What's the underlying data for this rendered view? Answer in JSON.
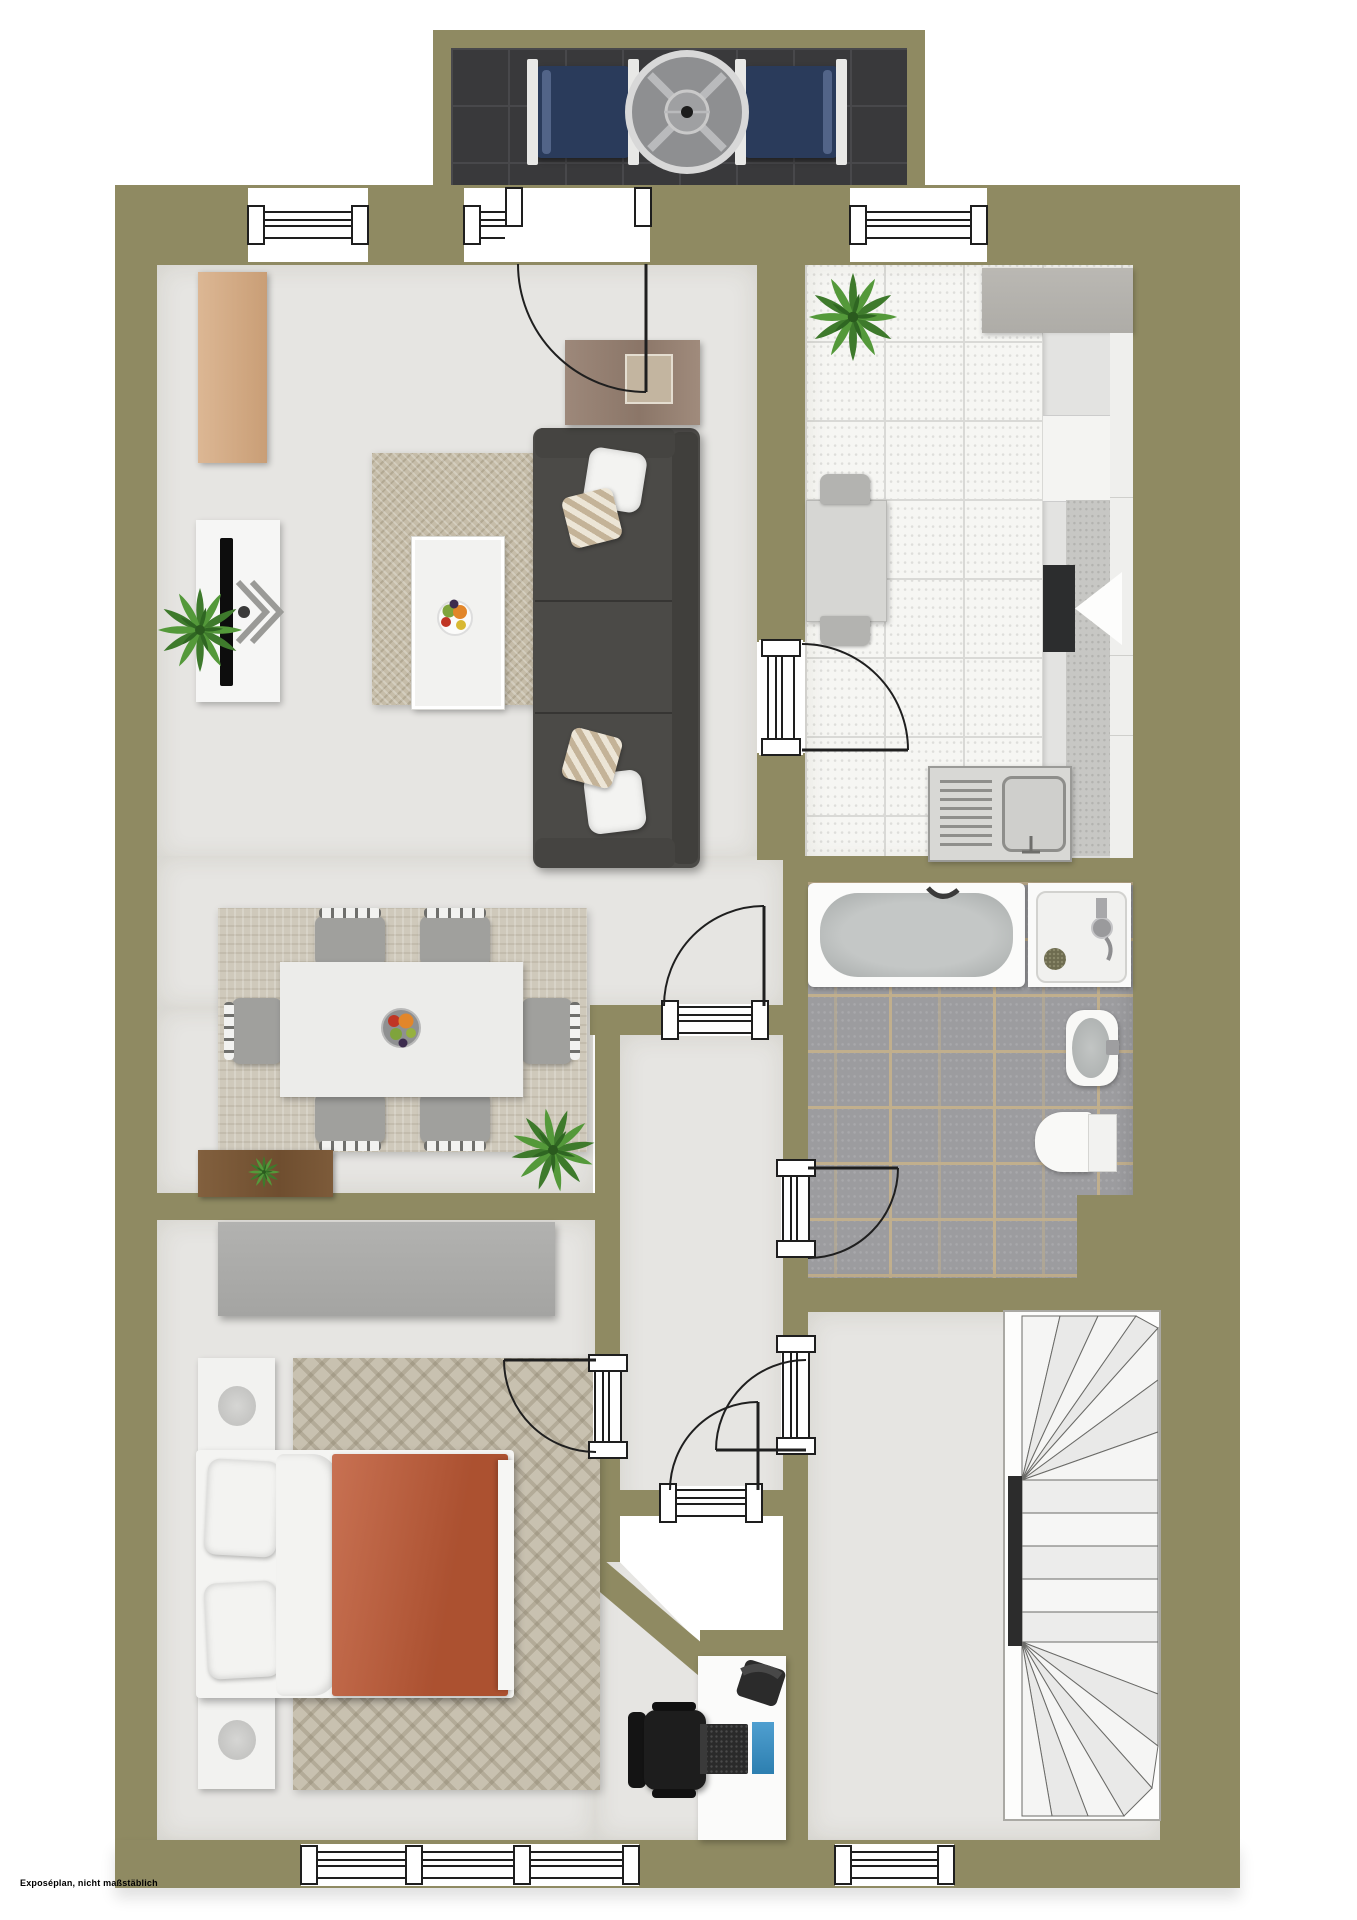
{
  "disclaimer": "Exposéplan, nicht maßstäblich",
  "palette": {
    "wall": "#8f8a62",
    "floor": "#e6e5e2",
    "balcony_floor": "#39393b",
    "kitchen_tile": "#f6f6f3",
    "bath_tile": "#9c9c9f",
    "bath_grout": "#c1af8d",
    "rug_living": "#c6bda9",
    "rug_dining": "#cfc9bb",
    "rug_bedroom": "#c8c1b0",
    "sofa": "#4b4a47",
    "bed_blanket": "#bf5a36",
    "wood_dark": "#7a5637",
    "wood_light": "#96816f",
    "tan_cabinet": "#d8b28c",
    "lounger": "#2a3b5b",
    "plant_green": "#4e8f35",
    "desk_accent_blue": "#4f9fd0"
  },
  "inventory": {
    "balcony": [
      "sun-lounger",
      "round-table",
      "sun-lounger"
    ],
    "living_room": [
      "tan-cabinet",
      "tv-board",
      "tv",
      "rug",
      "coffee-table",
      "fruit-bowl",
      "sofa",
      "cushions",
      "sideboard",
      "plant"
    ],
    "kitchen": [
      "plant",
      "worktop",
      "tall-unit",
      "stove",
      "sink-with-drainboard",
      "small-table",
      "two-chairs"
    ],
    "bathroom": [
      "bathtub",
      "shower",
      "washbasin",
      "toilet"
    ],
    "dining_area": [
      "rug",
      "dining-table",
      "six-chairs",
      "fruit-bowl",
      "wood-sideboard",
      "plant"
    ],
    "bedroom": [
      "wardrobe",
      "nightstand-with-lamp",
      "double-bed",
      "orange-blanket",
      "rug",
      "nightstand-with-lamp",
      "desk",
      "office-chair",
      "laptop",
      "telephone"
    ],
    "stair_room": [
      "winder-staircase",
      "handrail"
    ]
  },
  "counts": {
    "doors": 7,
    "windows_top": 3,
    "windows_bottom": 2,
    "dining_chairs": 6
  }
}
